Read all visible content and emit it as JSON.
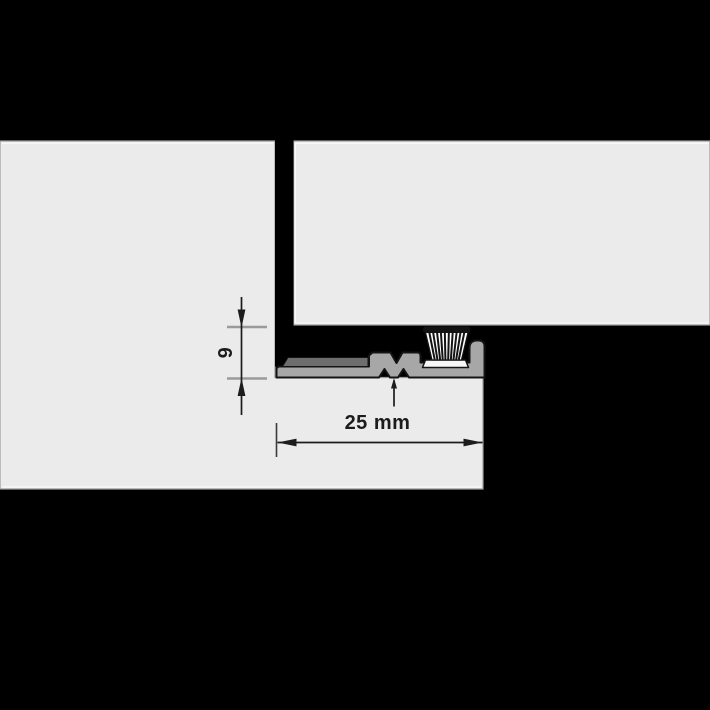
{
  "diagram": {
    "type": "door-threshold-profile-cross-section",
    "dimension_width": {
      "label": "25 mm"
    },
    "dimension_height": {
      "label": "6"
    },
    "colors": {
      "background": "#000000",
      "masonry": "#ebebeb",
      "profile": "#a7a7a7",
      "insert_strip": "#6e6e6e",
      "brush_plate": "#f7f7f7",
      "brush": "#ffffff",
      "crimp_band": "#121212",
      "dimension_line": "#1c1c1c",
      "extension_line": "#9a9a9a",
      "edge_highlight": "#fafafa",
      "block_outline": "#9c9c9c"
    }
  }
}
